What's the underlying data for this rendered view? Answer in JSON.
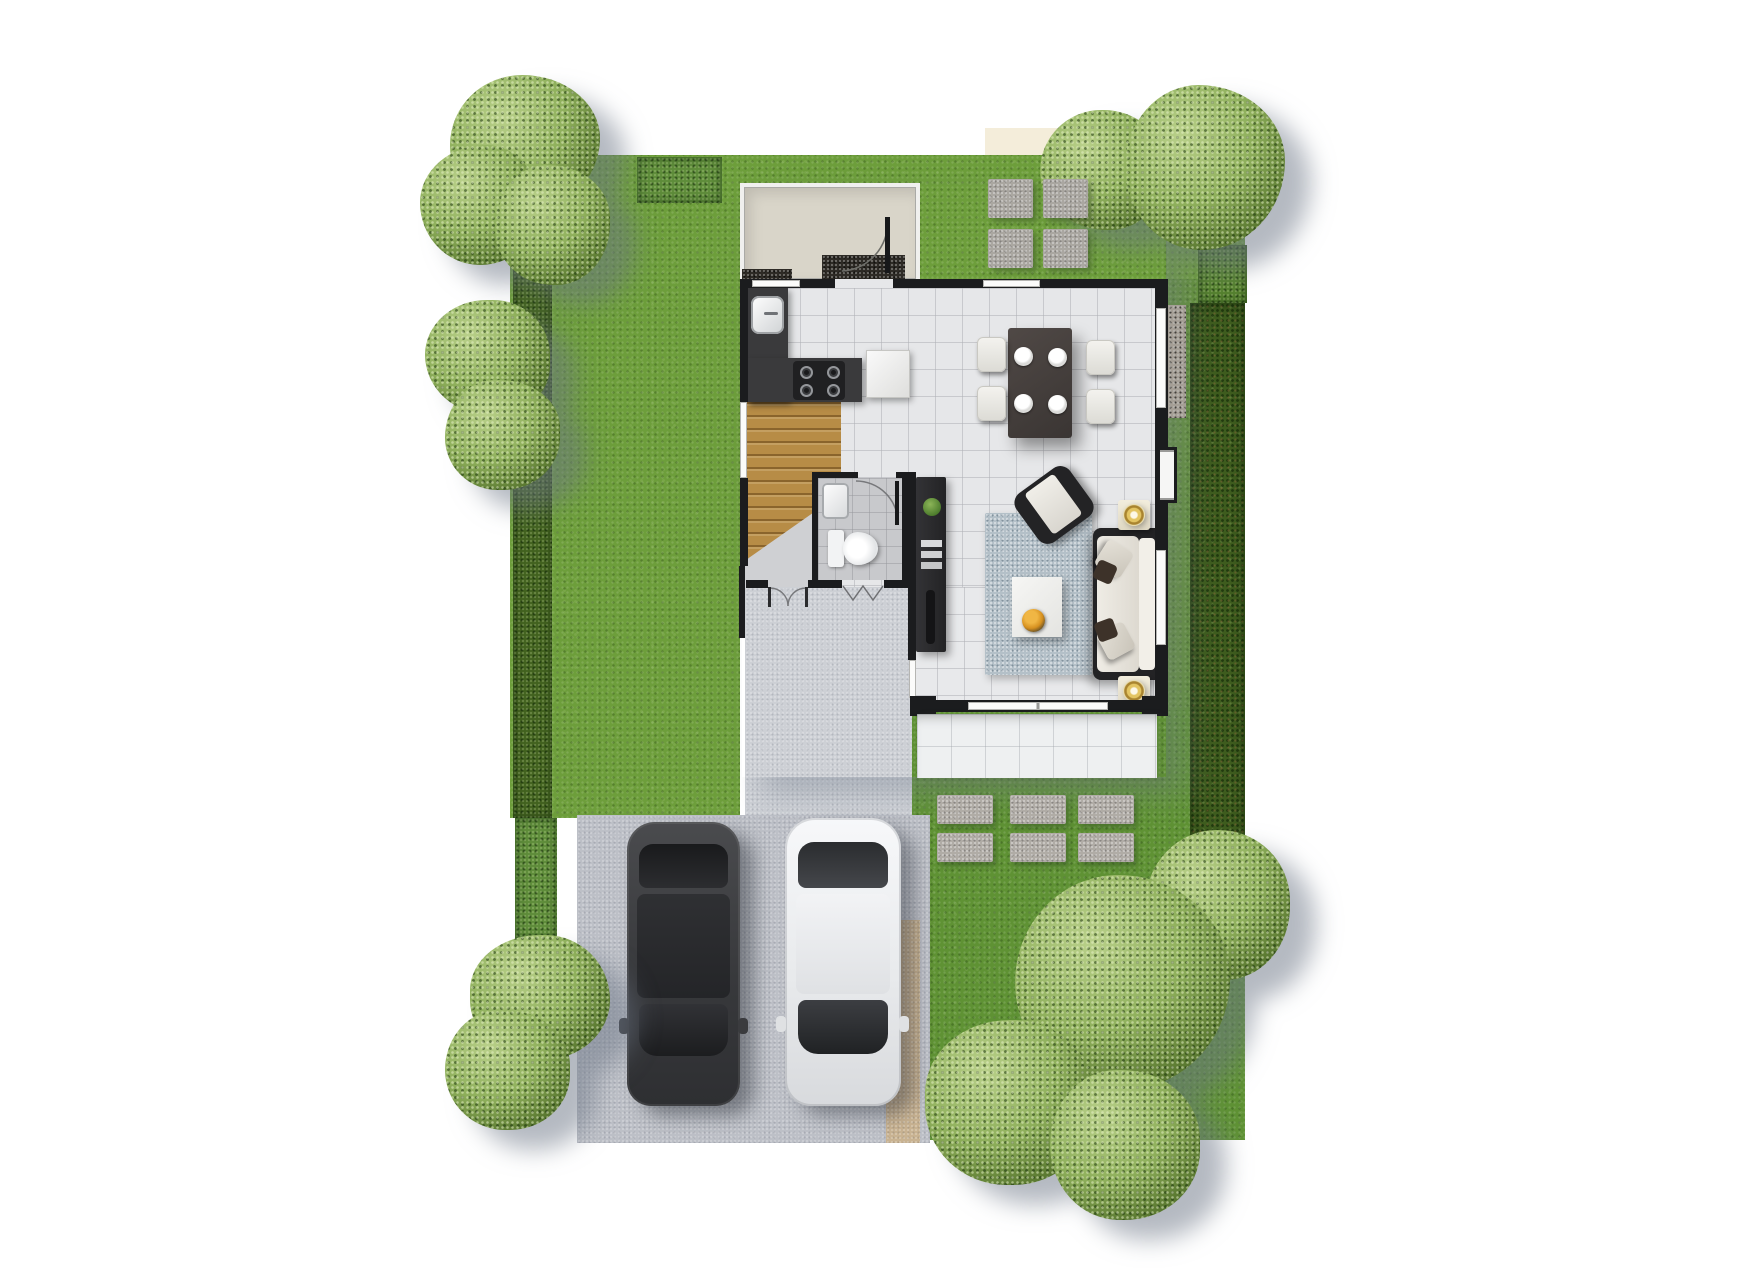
{
  "scene": {
    "title": "single-storey house plot plan, top-down render",
    "background": "#ffffff",
    "rooms": [
      "service-yard",
      "kitchen",
      "dining-area",
      "living-area",
      "stair-hall",
      "bathroom",
      "entry-porch",
      "terrace"
    ],
    "exterior": [
      "lawn",
      "hedges",
      "trees",
      "entry-stepping-stones",
      "garden-stepping-stones",
      "walkway",
      "driveway"
    ],
    "vehicles": [
      "dark-sedan",
      "white-sedan"
    ]
  },
  "palette": {
    "lawn": "#6d9e3b",
    "lawn_dark": "#5f9234",
    "hedge": "#42621f",
    "pavement": "#bdc0c7",
    "pavement_light": "#cdd0d5",
    "sand_strip": "#c9b392",
    "wall": "#1b1c1e",
    "wood_stairs": "#b78c46",
    "tile_floor": "#e6e7e9",
    "bath_floor": "#c8c9cc",
    "terrace": "#eef0f1",
    "rug": "#b4c0c8",
    "sofa_cushion": "#e9e6df",
    "furniture_dark": "#232325",
    "counter": "#3a3a3c",
    "bowl_accent": "#d6901f",
    "lamp_gold": "#c9a441",
    "car_dark": "#404144",
    "car_white": "#f0f2f4",
    "service_floor": "#d9d5c9"
  },
  "counts": {
    "entry_pavers": 4,
    "garden_pavers": 6,
    "dinner_plates": 4,
    "dining_chairs": 4,
    "stove_burners": 4,
    "cars": 2,
    "table_lamps": 2,
    "trees": 7,
    "sofa_pillows": 2
  },
  "groups": [
    {
      "name": "entry-paver",
      "cls": "paver-sq",
      "w": 45,
      "h": 39,
      "positions": [
        [
          988,
          179
        ],
        [
          1043,
          179
        ],
        [
          988,
          229
        ],
        [
          1043,
          229
        ]
      ]
    },
    {
      "name": "garden-paver",
      "cls": "paver-rect",
      "w": 56,
      "h": 29,
      "positions": [
        [
          937,
          795
        ],
        [
          1010,
          795
        ],
        [
          1078,
          795
        ],
        [
          937,
          833
        ],
        [
          1010,
          833
        ],
        [
          1078,
          833
        ]
      ]
    },
    {
      "name": "dinner-plate",
      "cls": "plate",
      "w": 19,
      "h": 19,
      "positions": [
        [
          1014,
          347
        ],
        [
          1048,
          348
        ],
        [
          1014,
          394
        ],
        [
          1048,
          395
        ]
      ]
    },
    {
      "name": "stove-burner",
      "cls": "burner",
      "w": 13,
      "h": 13,
      "positions": [
        [
          800,
          366
        ],
        [
          827,
          366
        ],
        [
          800,
          384
        ],
        [
          827,
          384
        ]
      ]
    },
    {
      "name": "dining-chair",
      "cls": "chair",
      "w": 29,
      "h": 35,
      "positions": [
        [
          977,
          337
        ],
        [
          977,
          386
        ],
        [
          1086,
          340
        ],
        [
          1086,
          389
        ]
      ]
    }
  ]
}
